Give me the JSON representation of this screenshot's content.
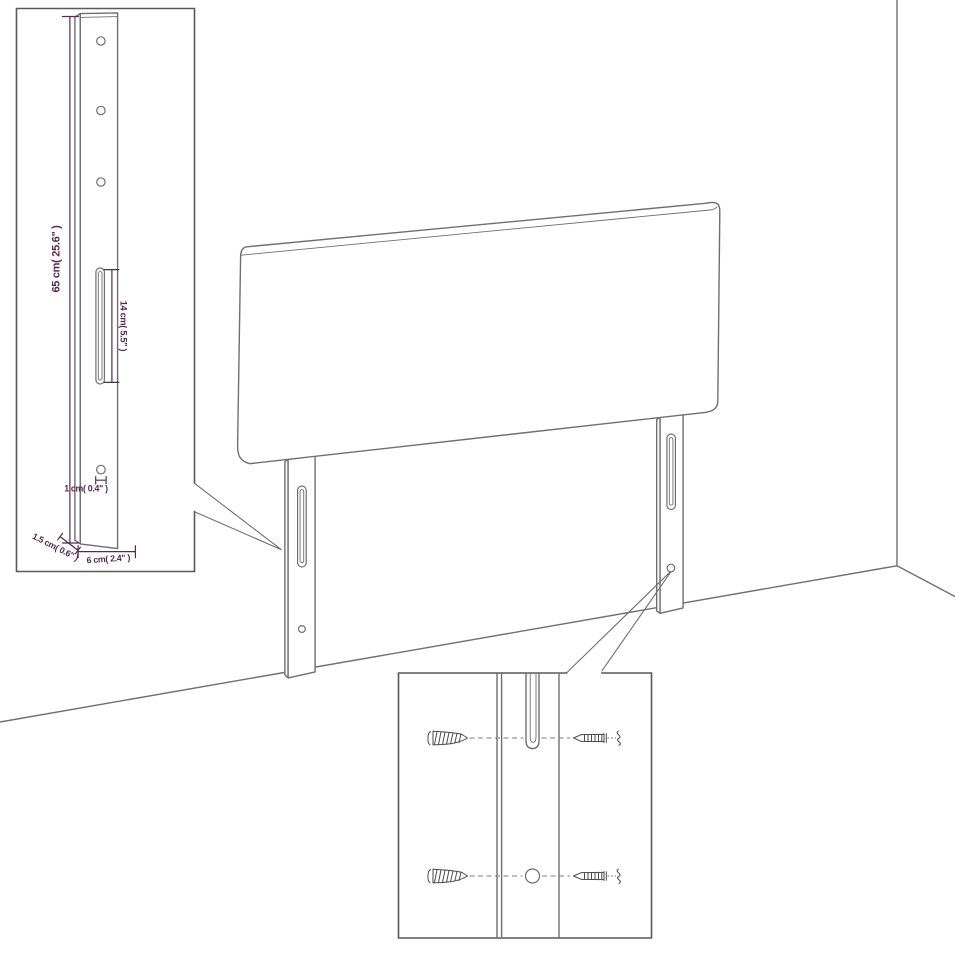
{
  "meta": {
    "kind": "product-dimension-diagram",
    "subject": "upholstered headboard with two mounting legs shown in a room corner"
  },
  "colors": {
    "background": "#ffffff",
    "outline": "#6f6f6f",
    "inset_border": "#595959",
    "dimension": "#552a4d",
    "screw": "#4a4a4a"
  },
  "leg_detail_inset": {
    "dimensions": {
      "height": "65 cm( 25.6\" )",
      "slot_length": "14 cm( 5.5\" )",
      "hole_diameter": "1 cm( 0.4\" )",
      "side_thickness": "1.5 cm( 0.6\" )",
      "width": "6 cm( 2.4\" )"
    }
  },
  "mounting_detail_inset": {
    "icons": [
      "wood-screw-icon",
      "machine-screw-icon",
      "phillips-head-end-icon"
    ]
  }
}
